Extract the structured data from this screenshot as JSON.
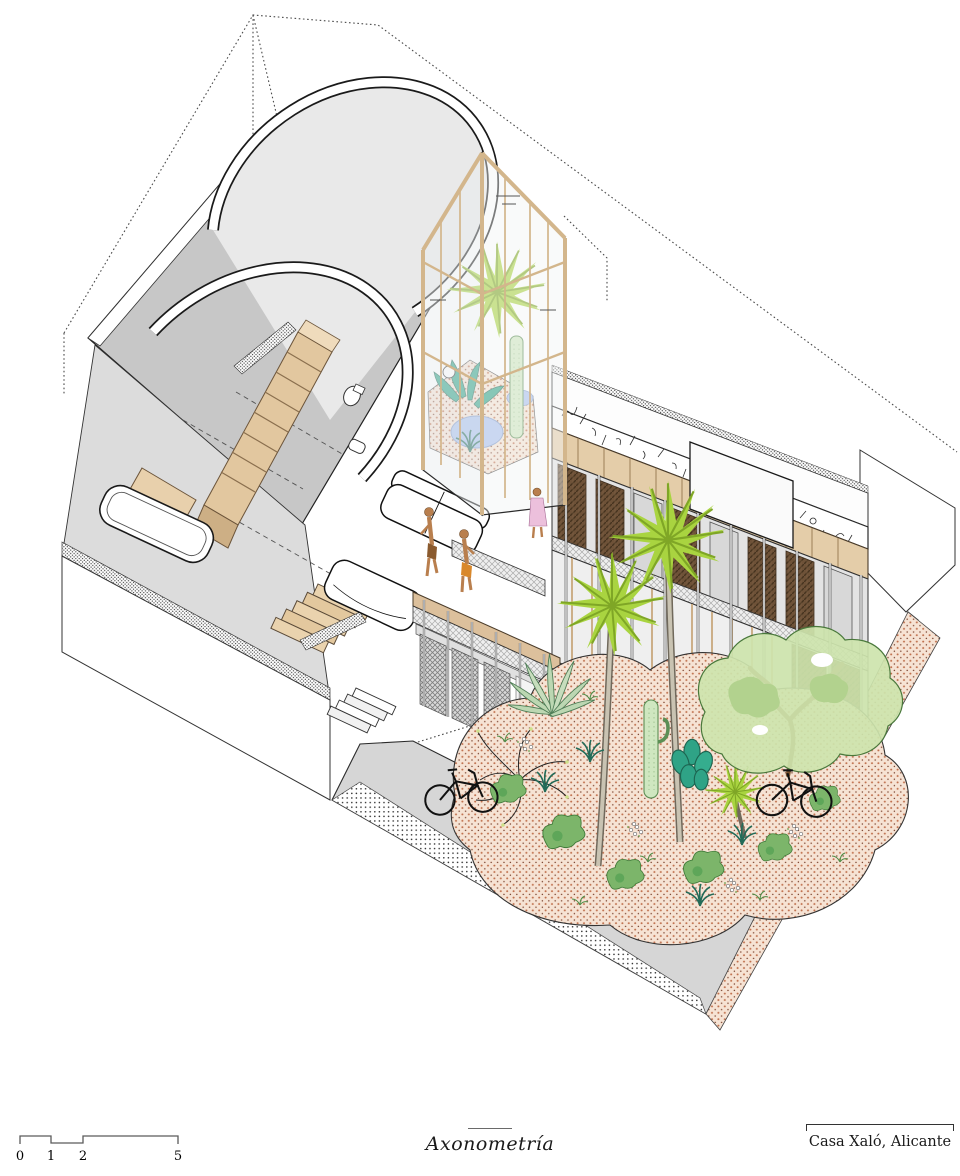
{
  "footer": {
    "scale_bar": {
      "labels": [
        "0",
        "1",
        "2",
        "5"
      ]
    },
    "drawing_label": "Axonometría",
    "title_block_label": "Casa Xaló, Alicante"
  },
  "palette": {
    "paper": "#ffffff",
    "line": "#1a1a1a",
    "roof_gray": "#c7c7c7",
    "floor_gray": "#dcdcdc",
    "ground_gray": "#d6d6d6",
    "wood": "#e3cda9",
    "wood_dark": "#b99a74",
    "shutter_brown": "#6e5238",
    "palm_green": "#a9d440",
    "leaf_teal": "#2fa386",
    "tree_green": "#cde4ad",
    "cactus_green": "#cfe7c0",
    "terracotta": "#c0714e",
    "water_blue": "#a9c0ee",
    "skin": "#b97f4e",
    "shorts_orange": "#d9882b",
    "dress_pink": "#ecc0dc"
  }
}
